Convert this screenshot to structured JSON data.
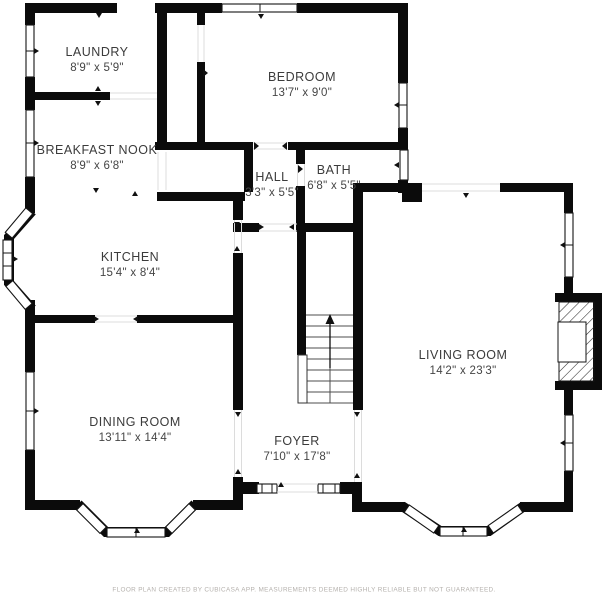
{
  "title": "Floor plan",
  "colors": {
    "wall": "#0b0b0b",
    "label": "#3b3b3b",
    "footer": "#b5b1ad",
    "background": "#ffffff"
  },
  "rooms": [
    {
      "id": "laundry",
      "name": "LAUNDRY",
      "dims": "8'9\" x 5'9\""
    },
    {
      "id": "bedroom",
      "name": "BEDROOM",
      "dims": "13'7\" x 9'0\""
    },
    {
      "id": "breakfast-nook",
      "name": "BREAKFAST NOOK",
      "dims": "8'9\" x 6'8\""
    },
    {
      "id": "hall",
      "name": "HALL",
      "dims": "3'3\" x 5'5\""
    },
    {
      "id": "bath",
      "name": "BATH",
      "dims": "6'8\" x 5'5\""
    },
    {
      "id": "kitchen",
      "name": "KITCHEN",
      "dims": "15'4\" x 8'4\""
    },
    {
      "id": "living-room",
      "name": "LIVING ROOM",
      "dims": "14'2\" x 23'3\""
    },
    {
      "id": "dining-room",
      "name": "DINING ROOM",
      "dims": "13'11\" x 14'4\""
    },
    {
      "id": "foyer",
      "name": "FOYER",
      "dims": "7'10\" x 17'8\""
    }
  ],
  "stairs": {
    "direction": "up"
  },
  "footer": {
    "text": "FLOOR PLAN CREATED BY CUBICASA APP. MEASUREMENTS DEEMED HIGHLY RELIABLE BUT NOT GUARANTEED."
  }
}
